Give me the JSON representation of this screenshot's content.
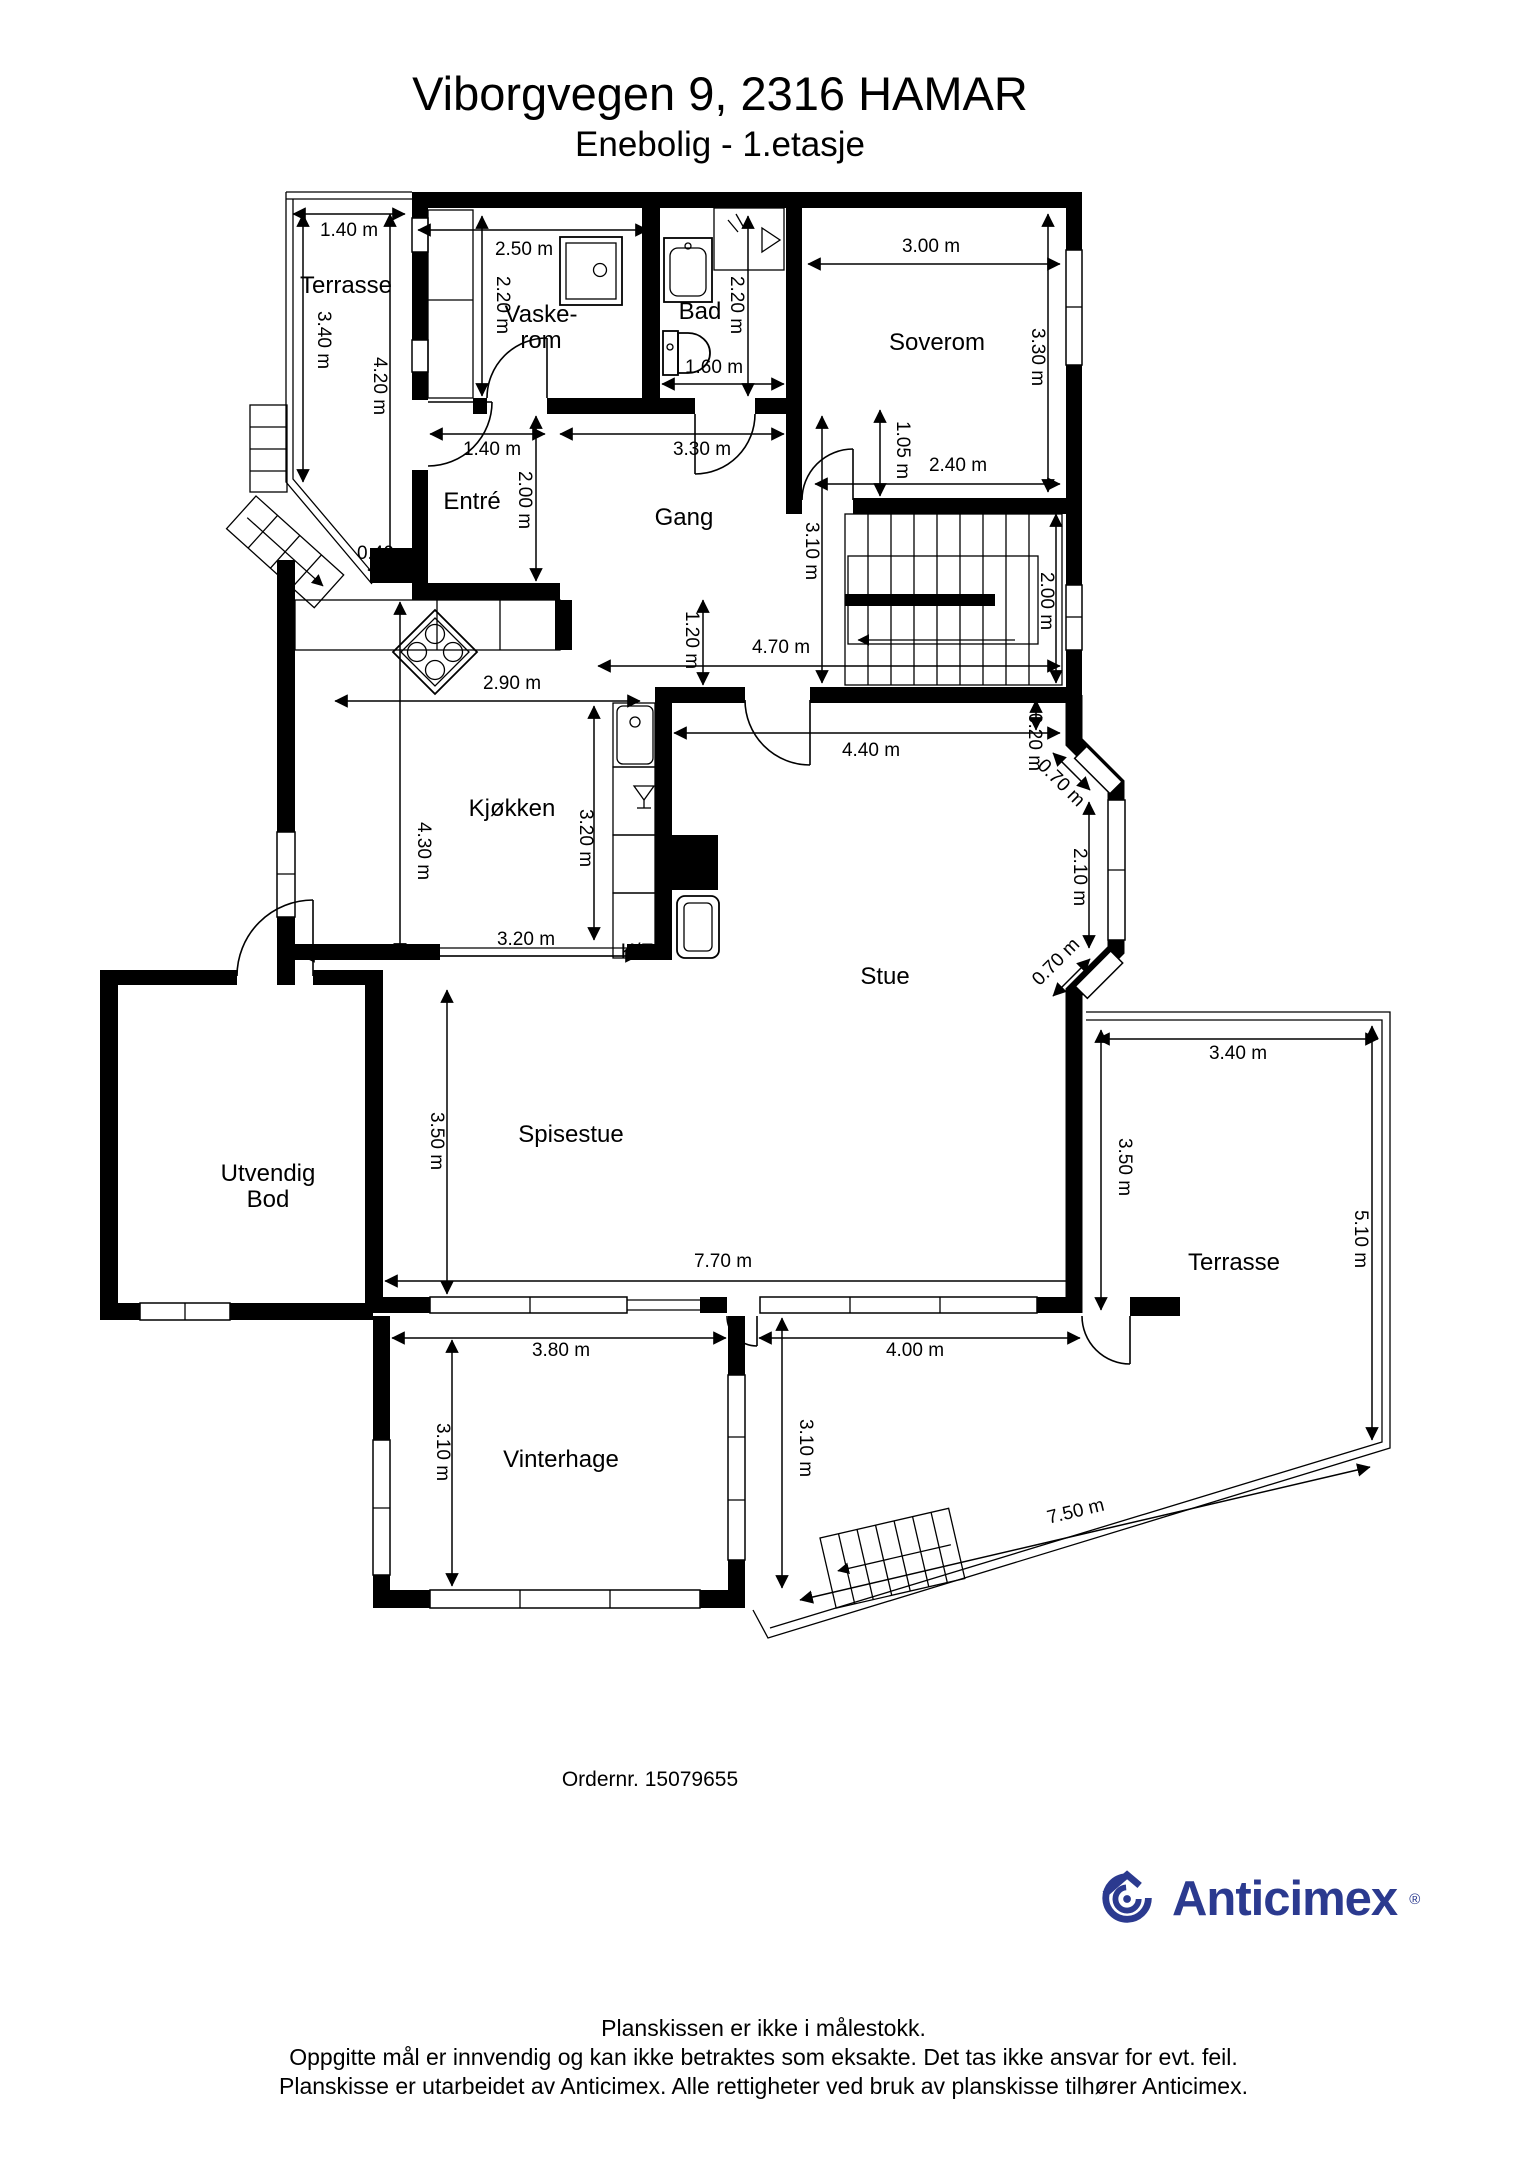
{
  "header": {
    "title": "Viborgvegen 9, 2316 HAMAR",
    "subtitle": "Enebolig - 1.etasje"
  },
  "order": {
    "label": "Ordernr. 15079655"
  },
  "branding": {
    "logo_text": "Anticimex",
    "registered_mark": "®",
    "logo_color": "#2b3a8f"
  },
  "footer": {
    "line1": "Planskissen er ikke i målestokk.",
    "line2": "Oppgitte mål er innvendig og kan ikke betraktes som eksakte. Det tas ikke ansvar for evt. feil.",
    "line3": "Planskisse er utarbeidet av Anticimex. Alle rettigheter ved bruk av planskisse tilhører Anticimex."
  },
  "icons": [
    "washing-machine-icon",
    "bathroom-sink-ic on",
    "toilet-icon",
    "shower-icon",
    "cooktop-icon",
    "kitchen-sink-icon",
    "dishwasher-icon",
    "fireplace-icon",
    "stairs-icon",
    "anticimex-logo-icon"
  ],
  "floorplan": {
    "rooms": [
      {
        "name": "room-label-terrasse-left",
        "label": "Terrasse",
        "x": 346,
        "y": 293
      },
      {
        "name": "room-label-vaskerom",
        "label": "Vaske-\nrom",
        "x": 541,
        "y": 322
      },
      {
        "name": "room-label-bad",
        "label": "Bad",
        "x": 700,
        "y": 319
      },
      {
        "name": "room-label-soverom",
        "label": "Soverom",
        "x": 937,
        "y": 350
      },
      {
        "name": "room-label-entre",
        "label": "Entré",
        "x": 472,
        "y": 509
      },
      {
        "name": "room-label-gang",
        "label": "Gang",
        "x": 684,
        "y": 525
      },
      {
        "name": "room-label-kjokken",
        "label": "Kjøkken",
        "x": 512,
        "y": 816
      },
      {
        "name": "room-label-stue",
        "label": "Stue",
        "x": 885,
        "y": 984
      },
      {
        "name": "room-label-spisestue",
        "label": "Spisestue",
        "x": 571,
        "y": 1142
      },
      {
        "name": "room-label-utvendig-bod",
        "label": "Utvendig\nBod",
        "x": 268,
        "y": 1181
      },
      {
        "name": "room-label-vinterhage",
        "label": "Vinterhage",
        "x": 561,
        "y": 1467
      },
      {
        "name": "room-label-terrasse-right",
        "label": "Terrasse",
        "x": 1234,
        "y": 1270
      }
    ],
    "fixtures": [
      {
        "name": "fixture-label-fridge-freezer",
        "label": "K/F",
        "x": 637,
        "y": 958
      }
    ],
    "dimensions": [
      {
        "label": "1.40 m",
        "x": 349,
        "y": 236,
        "rot": 0
      },
      {
        "label": "3.40 m",
        "x": 318,
        "y": 340,
        "rot": 90
      },
      {
        "label": "4.20 m",
        "x": 374,
        "y": 386,
        "rot": 90
      },
      {
        "label": "2.50 m",
        "x": 524,
        "y": 255,
        "rot": 0
      },
      {
        "label": "2.20 m",
        "x": 497,
        "y": 305,
        "rot": 90
      },
      {
        "label": "2.20 m",
        "x": 731,
        "y": 305,
        "rot": 90
      },
      {
        "label": "1.60 m",
        "x": 714,
        "y": 373,
        "rot": 0
      },
      {
        "label": "3.00 m",
        "x": 931,
        "y": 252,
        "rot": 0
      },
      {
        "label": "3.30 m",
        "x": 1032,
        "y": 357,
        "rot": 90
      },
      {
        "label": "2.40 m",
        "x": 958,
        "y": 471,
        "rot": 0
      },
      {
        "label": "1.05 m",
        "x": 897,
        "y": 450,
        "rot": 90
      },
      {
        "label": "1.40 m",
        "x": 492,
        "y": 455,
        "rot": 0
      },
      {
        "label": "3.30 m",
        "x": 702,
        "y": 455,
        "rot": 0
      },
      {
        "label": "2.00 m",
        "x": 519,
        "y": 500,
        "rot": 90
      },
      {
        "label": "0.40 m",
        "x": 386,
        "y": 559,
        "rot": 0
      },
      {
        "label": "3.10 m",
        "x": 806,
        "y": 551,
        "rot": 90
      },
      {
        "label": "4.70 m",
        "x": 781,
        "y": 653,
        "rot": 0
      },
      {
        "label": "2.00 m",
        "x": 1041,
        "y": 601,
        "rot": 90
      },
      {
        "label": "1.20 m",
        "x": 686,
        "y": 640,
        "rot": 90
      },
      {
        "label": "2.90 m",
        "x": 512,
        "y": 689,
        "rot": 0
      },
      {
        "label": "4.30 m",
        "x": 418,
        "y": 851,
        "rot": 90
      },
      {
        "label": "3.20 m",
        "x": 580,
        "y": 838,
        "rot": 90
      },
      {
        "label": "3.20 m",
        "x": 526,
        "y": 945,
        "rot": 0
      },
      {
        "label": "4.40 m",
        "x": 871,
        "y": 756,
        "rot": 0
      },
      {
        "label": "0.20 m",
        "x": 1029,
        "y": 742,
        "rot": 90
      },
      {
        "label": "0.70 m",
        "x": 1057,
        "y": 787,
        "rot": 45
      },
      {
        "label": "2.10 m",
        "x": 1074,
        "y": 877,
        "rot": 90
      },
      {
        "label": "0.70 m",
        "x": 1060,
        "y": 966,
        "rot": -45
      },
      {
        "label": "3.50 m",
        "x": 431,
        "y": 1141,
        "rot": 90
      },
      {
        "label": "7.70 m",
        "x": 723,
        "y": 1267,
        "rot": 0
      },
      {
        "label": "3.80 m",
        "x": 561,
        "y": 1356,
        "rot": 0
      },
      {
        "label": "4.00 m",
        "x": 915,
        "y": 1356,
        "rot": 0
      },
      {
        "label": "3.10 m",
        "x": 437,
        "y": 1452,
        "rot": 90
      },
      {
        "label": "3.10 m",
        "x": 800,
        "y": 1448,
        "rot": 90
      },
      {
        "label": "3.40 m",
        "x": 1238,
        "y": 1059,
        "rot": 0
      },
      {
        "label": "3.50 m",
        "x": 1119,
        "y": 1167,
        "rot": 90
      },
      {
        "label": "5.10 m",
        "x": 1355,
        "y": 1239,
        "rot": 90
      },
      {
        "label": "7.50 m",
        "x": 1077,
        "y": 1517,
        "rot": -13.5
      }
    ]
  }
}
